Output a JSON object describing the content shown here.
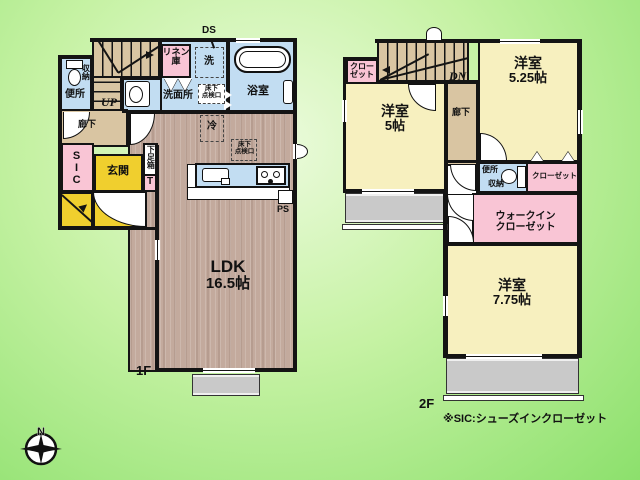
{
  "title": "戸建て間取り図 1F・2F",
  "floor1": {
    "floor_label": "1F",
    "ds": "DS",
    "ldk": {
      "name": "LDK",
      "area": "16.5帖"
    },
    "bath": "浴室",
    "washroom": "洗面所",
    "washer": "洗",
    "linen_line1": "リネン",
    "linen_line2": "庫",
    "toilet": "便所",
    "toilet_storage": "収納",
    "hall": "廊下",
    "up": "UP",
    "sic": "SIC",
    "genkan": "玄関",
    "shoebox": "下足箱",
    "shoebox_t": "T",
    "fridge": "冷",
    "inspection_line1": "床下",
    "inspection_line2": "点検口",
    "ps": "PS"
  },
  "floor2": {
    "floor_label": "2F",
    "dn": "DN",
    "hall": "廊下",
    "closet_a_line1": "クロー",
    "closet_a_line2": "ゼット",
    "room5": {
      "name": "洋室",
      "area": "5帖"
    },
    "room525": {
      "name": "洋室",
      "area": "5.25帖"
    },
    "room775": {
      "name": "洋室",
      "area": "7.75帖"
    },
    "toilet": "便所",
    "toilet_storage": "収納",
    "closet_b": "クローゼット",
    "wic_line1": "ウォークイン",
    "wic_line2": "クローゼット"
  },
  "note": "※SIC:シューズインクローゼット",
  "compass": {
    "north": "N"
  },
  "colors": {
    "background_green": "#8ce06c",
    "wall": "#141414",
    "wood_floor": "#c3aa9d",
    "tatami_room": "#f7f0bf",
    "corridor_tan": "#d9c5a2",
    "wet_area_blue": "#c2ddf2",
    "closet_pink": "#f9c5d5",
    "entrance_gold": "#f0cf2e",
    "balcony_gray": "#c9c9c9"
  }
}
